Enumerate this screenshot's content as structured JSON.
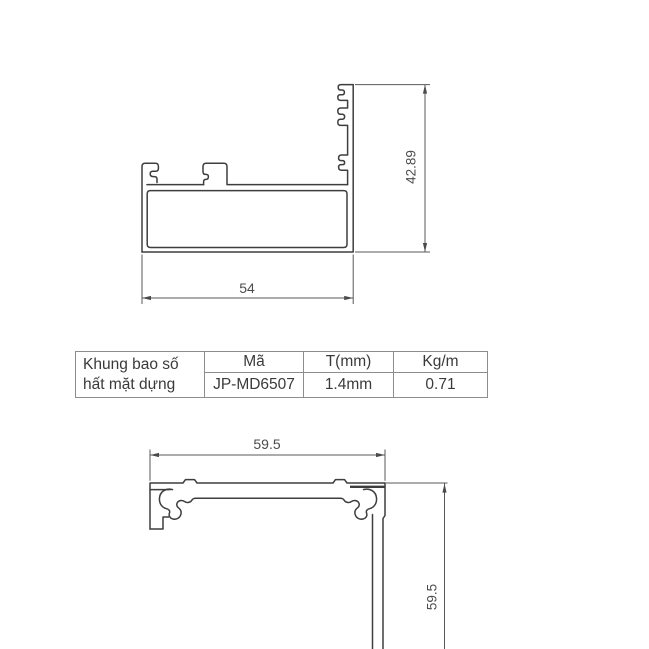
{
  "drawings": {
    "top": {
      "name": "top-profile-section",
      "width_dim": "54",
      "height_dim": "42.89"
    },
    "bottom": {
      "name": "bottom-corner-profile-section",
      "width_dim": "59.5",
      "height_dim": "59.5"
    }
  },
  "spec_table": {
    "product_name_line1": "Khung bao số",
    "product_name_line2": "hất mặt dựng",
    "columns": [
      {
        "header": "Mã",
        "value": "JP-MD6507"
      },
      {
        "header": "T(mm)",
        "value": "1.4mm"
      },
      {
        "header": "Kg/m",
        "value": "0.71"
      }
    ]
  },
  "colors": {
    "background": "#ffffff",
    "profile_line": "#3e3e3e",
    "dimension_line": "#585858",
    "table_border": "#8d8d8d",
    "text": "#3a3a3a"
  }
}
